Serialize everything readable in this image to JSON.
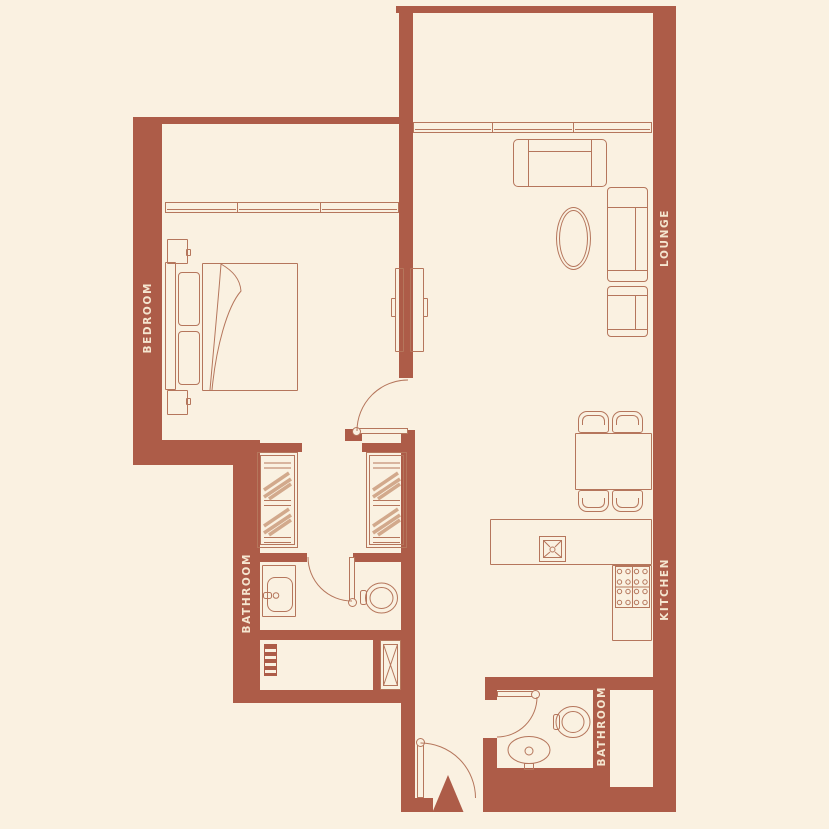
{
  "colors": {
    "bg": "#faf1e1",
    "wall": "#ad5c48",
    "line": "#b5765c",
    "hatch": "#d2a98c",
    "label": "#f5e6d0"
  },
  "rooms": {
    "bedroom": {
      "label": "BEDROOM"
    },
    "lounge": {
      "label": "LOUNGE"
    },
    "kitchen": {
      "label": "KITCHEN"
    },
    "bathroom1": {
      "label": "BATHROOM"
    },
    "bathroom2": {
      "label": "BATHROOM"
    }
  }
}
